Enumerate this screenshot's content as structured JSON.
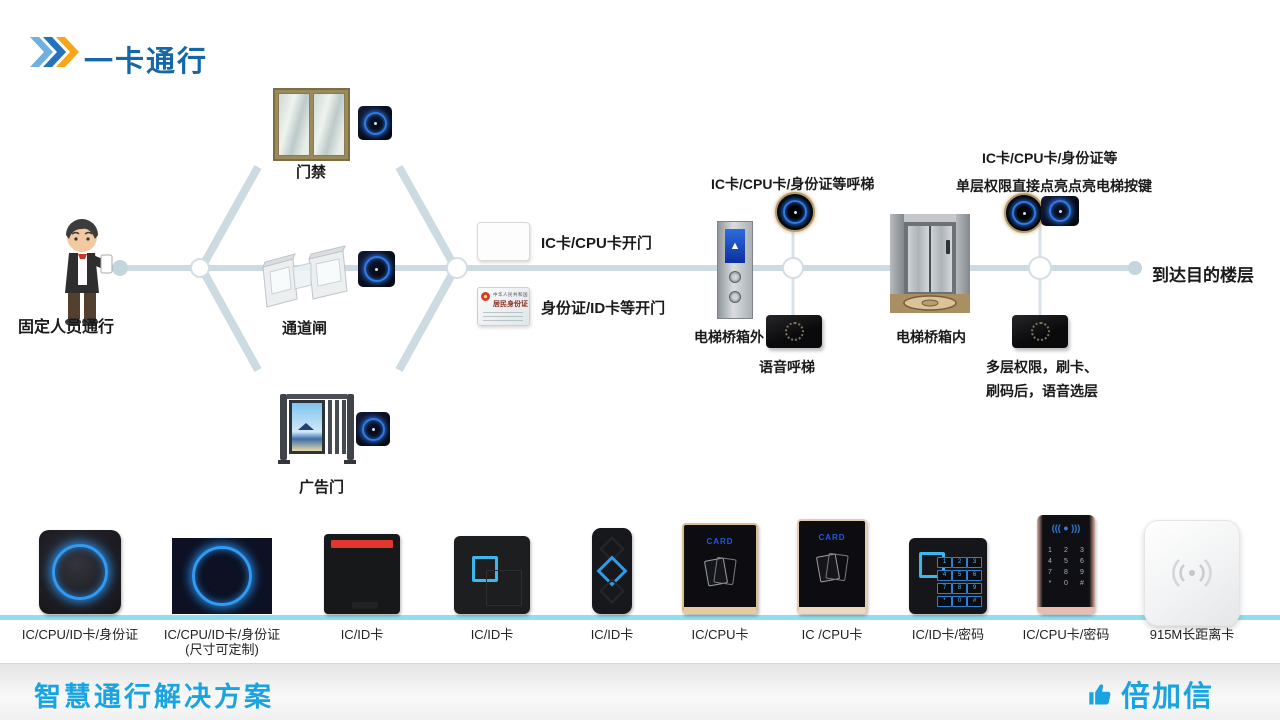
{
  "header": {
    "title": "一卡通行"
  },
  "diagram": {
    "person_label": "固定人员通行",
    "gate_door_label": "门禁",
    "gate_channel_label": "通道闸",
    "gate_ad_label": "广告门",
    "card_open_label": "IC卡/CPU卡开门",
    "idcard_open_label": "身份证/ID卡等开门",
    "idcard_country": "中华人民共和国",
    "idcard_title": "居民身份证",
    "call_label": "IC卡/CPU卡/身份证等呼梯",
    "outside_label": "电梯桥箱外",
    "voice_call_label": "语音呼梯",
    "inside_top1": "IC卡/CPU卡/身份证等",
    "inside_top2": "单层权限直接点亮点亮电梯按键",
    "inside_label": "电梯桥箱内",
    "multi_line1": "多层权限，刷卡、",
    "multi_line2": "刷码后，语音选层",
    "destination_label": "到达目的楼层",
    "elevator_up_arrow": "▲"
  },
  "products": [
    {
      "label": "IC/CPU/ID卡/身份证"
    },
    {
      "label": "IC/CPU/ID卡/身份证",
      "label2": "(尺寸可定制)"
    },
    {
      "label": "IC/ID卡"
    },
    {
      "label": "IC/ID卡"
    },
    {
      "label": "IC/ID卡"
    },
    {
      "label": "IC/CPU卡",
      "screen_text": "CARD"
    },
    {
      "label": "IC /CPU卡",
      "screen_text": "CARD"
    },
    {
      "label": "IC/ID卡/密码",
      "keys": [
        "1",
        "2",
        "3",
        "4",
        "5",
        "6",
        "7",
        "8",
        "9",
        "*",
        "0",
        "#"
      ]
    },
    {
      "label": "IC/CPU卡/密码",
      "wave_text": "((( ● )))",
      "keys": [
        "1",
        "2",
        "3",
        "4",
        "5",
        "6",
        "7",
        "8",
        "9",
        "*",
        "0",
        "#"
      ]
    },
    {
      "label": "915M长距离卡"
    }
  ],
  "footer": {
    "title": "智慧通行解决方案",
    "brand": "倍加信"
  },
  "colors": {
    "title_blue": "#1667A8",
    "accent_cyan": "#18A4E0",
    "connector_line": "#CCDAE2",
    "divider_cyan": "#90DFF0",
    "ring_blue": "#2F7BEA",
    "chevron_light_blue": "#6FB0E0",
    "chevron_blue": "#2273B9",
    "chevron_orange": "#F9A51A"
  }
}
